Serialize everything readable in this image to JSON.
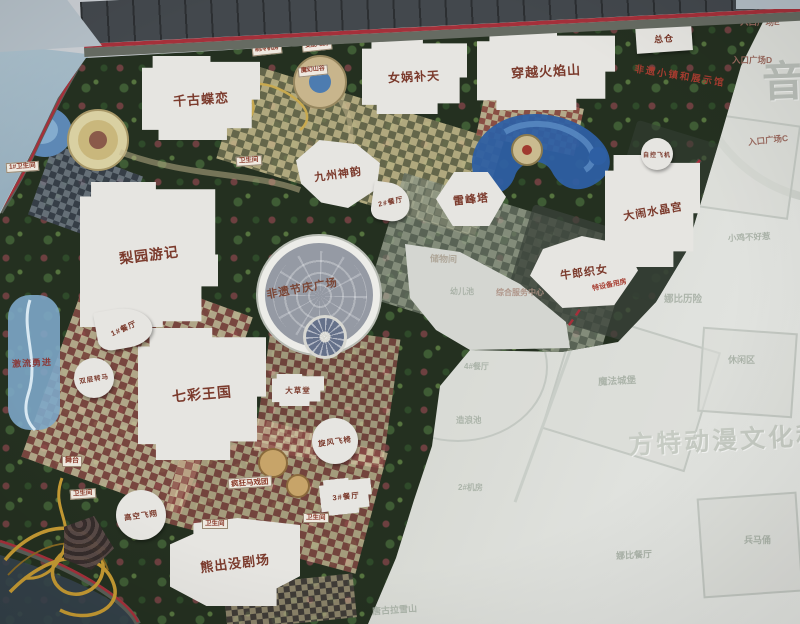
{
  "labels": {
    "qiangudielian": "千古蝶恋",
    "nvwabutian": "女娲补天",
    "chuanyuehuoyanshan": "穿越火焰山",
    "zongcang": "总仓",
    "jiuzhoushenyun": "九州神韵",
    "leifengta": "雷峰塔",
    "danaoshuijinggong": "大闹水晶宫",
    "niulangzhinv": "牛郎织女",
    "liyuanyouji": "梨园游记",
    "feiyijieqingguangchang": "非遗节庆广场",
    "qicaiwangguo": "七彩王国",
    "xiongchumojuchang": "熊出没剧场",
    "canting1": "1#餐厅",
    "canting2": "2#餐厅",
    "canting3": "3#餐厅",
    "canting4": "4#餐厅",
    "shuangcengzhuanma": "双层转马",
    "gaokongfeixiang": "高空飞翔",
    "xuanfengfeiyi": "旋风飞椅",
    "dacaotang": "大草堂",
    "fengkuangmaxituan": "疯狂马戏团",
    "wutai": "舞台",
    "jiliuyongjin": "激流勇进",
    "zikongfeiji": "自控飞机",
    "wc1": "1#卫生间",
    "wc2": "卫生间",
    "wc3": "卫生间",
    "wc4": "卫生间",
    "wc5": "卫生间",
    "zhilengjifang": "制冷机房",
    "bianpeidianfang": "变配电房",
    "mohuanshangu": "魔幻山谷",
    "teshebeiyongfang": "特设备用房",
    "feiyixiaozhen": "非遗小镇和展示馆",
    "gate_e": "入口广场E",
    "gate_d": "入口广场D",
    "gate_c": "入口广场C",
    "yin": "音",
    "chuwujian": "储物间",
    "youerchi": "幼儿池",
    "zonghefuwu": "综合服务中心",
    "zaolangchi": "造浪池",
    "mofachengbao": "魔法城堡",
    "nabilixian": "娜比历险",
    "xiaojibuhaore": "小鸡不好惹",
    "xiuxianqu": "休闲区",
    "jifang2": "2#机房",
    "tanggulaxueshan": "唐古拉雪山",
    "nabicanting": "娜比餐厅",
    "bingmayong": "兵马俑",
    "fantedongman": "方特动漫文化科技"
  },
  "colors": {
    "accent_red": "#a5303a",
    "attraction_text": "#7b3a2c",
    "faded_text": "#a7b0a5",
    "note_red": "#a63c30"
  }
}
